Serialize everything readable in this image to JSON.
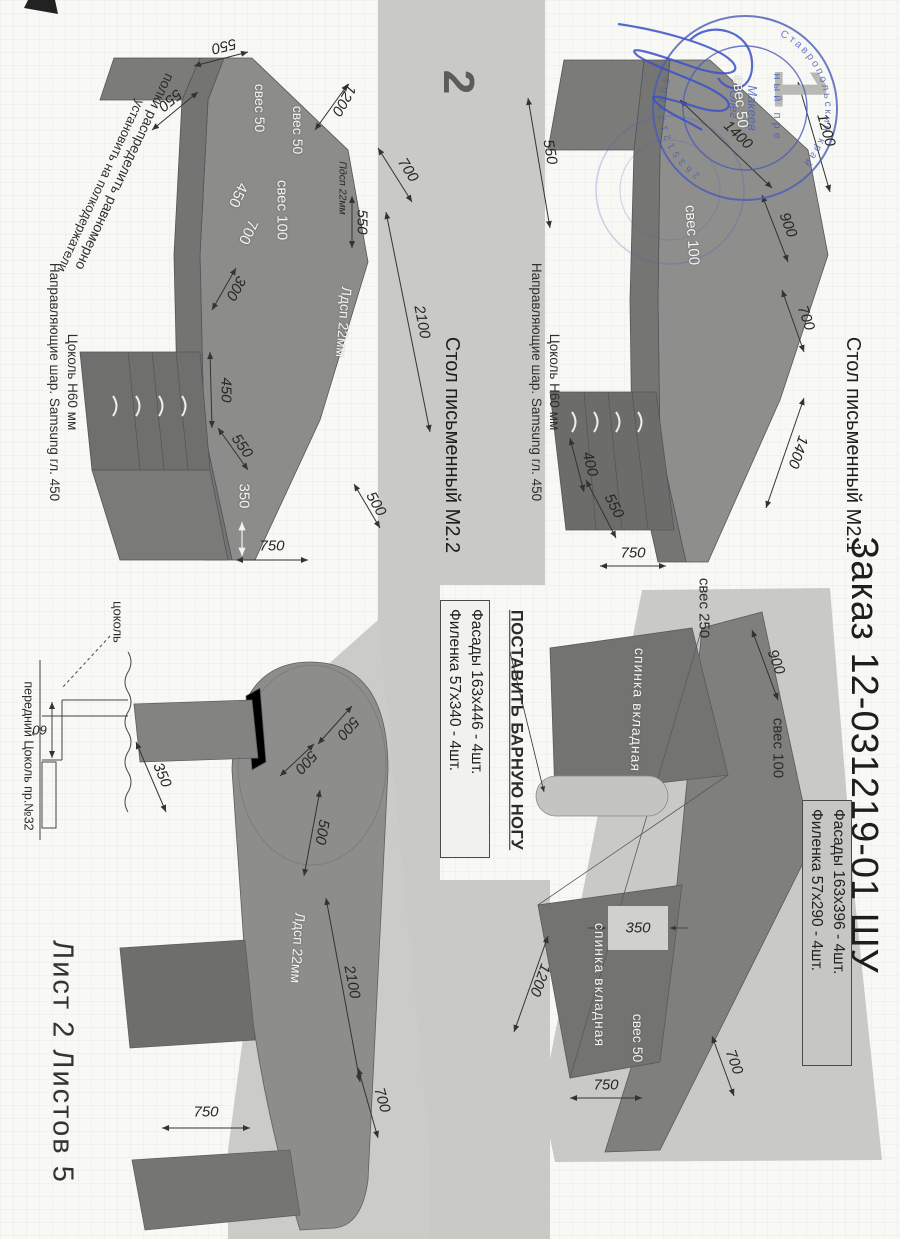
{
  "document": {
    "order_title": "Заказ 12-031219-01 ШУ",
    "sheet_footer": "Лист 2  Листов 5",
    "page_number_1": "1",
    "page_number_2": "2"
  },
  "stamp": {
    "arc_text": "Ставропольский край",
    "arc_digits": "263512172805",
    "inner_top": "ный пре",
    "name": "Макеев",
    "first_name": "Олег"
  },
  "m21": {
    "title": "Стол письменный М2.1",
    "plinth_note_line1": "Цоколь  Н60 мм",
    "plinth_note_line2": "Направляющие шар. Samsung гл. 450",
    "front": {
      "overhang_50": "свес 50",
      "overhang_100": "свес 100",
      "dim_550_left": "550",
      "dim_1200": "1200",
      "dim_1400_left": "1400",
      "dim_900": "900",
      "dim_700": "700",
      "dim_1400_right": "1400",
      "dim_400": "400",
      "dim_550_right": "550",
      "dim_750": "750"
    },
    "back": {
      "insert_back_1": "спинка вкладная",
      "insert_back_2": "спинка вкладная",
      "bar_leg_note": "ПОСТАВИТЬ БАРНУЮ НОГУ",
      "overhang_250": "свес 250",
      "overhang_100": "свес 100",
      "overhang_50": "свес 50",
      "dim_900": "900",
      "dim_350": "350",
      "dim_1200": "1200",
      "dim_700": "700",
      "dim_750": "750"
    },
    "facade_box": {
      "line1": "Фасады 163х396 - 4шт.",
      "line2": "Филенка 57х290 - 4шт."
    }
  },
  "m22": {
    "title": "Стол письменный М2.2",
    "shelf_note_line1": "полки распределить равномерно",
    "shelf_note_line2": "установить на полкодержатели",
    "plinth_note_line1": "Цоколь  Н60 мм",
    "plinth_note_line2": "Направляющие шар. Samsung гл. 450",
    "corner": {
      "overhang_50_a": "свес 50",
      "overhang_50_b": "свес 50",
      "overhang_100": "свес 100",
      "top_450": "450",
      "top_700": "700",
      "board_label": "Лдсп 22мм",
      "board_small": "Пдсп 22мм",
      "white_350": "350",
      "dim_550_top": "550",
      "dim_550_left": "550",
      "dim_550_mid": "550",
      "dim_550_diag": "550",
      "dim_1200": "1200",
      "dim_300": "300",
      "dim_450": "450",
      "dim_750": "750",
      "dim_500": "500",
      "dim_2100": "2100",
      "dim_700": "700"
    },
    "side": {
      "board_label": "Лдсп 22мм",
      "dim_350": "350",
      "dim_500_a": "500",
      "dim_500_b": "500",
      "dim_500_c": "500",
      "dim_2100": "2100",
      "dim_700": "700",
      "dim_750": "750"
    },
    "facade_box": {
      "line1": "Фасады 163х446 - 4шт.",
      "line2": "Филенка 57х340 - 4шт."
    },
    "plinth_detail": {
      "label": "цоколь",
      "dim_60": "60",
      "caption": "передний Цоколь пр.№32"
    }
  }
}
